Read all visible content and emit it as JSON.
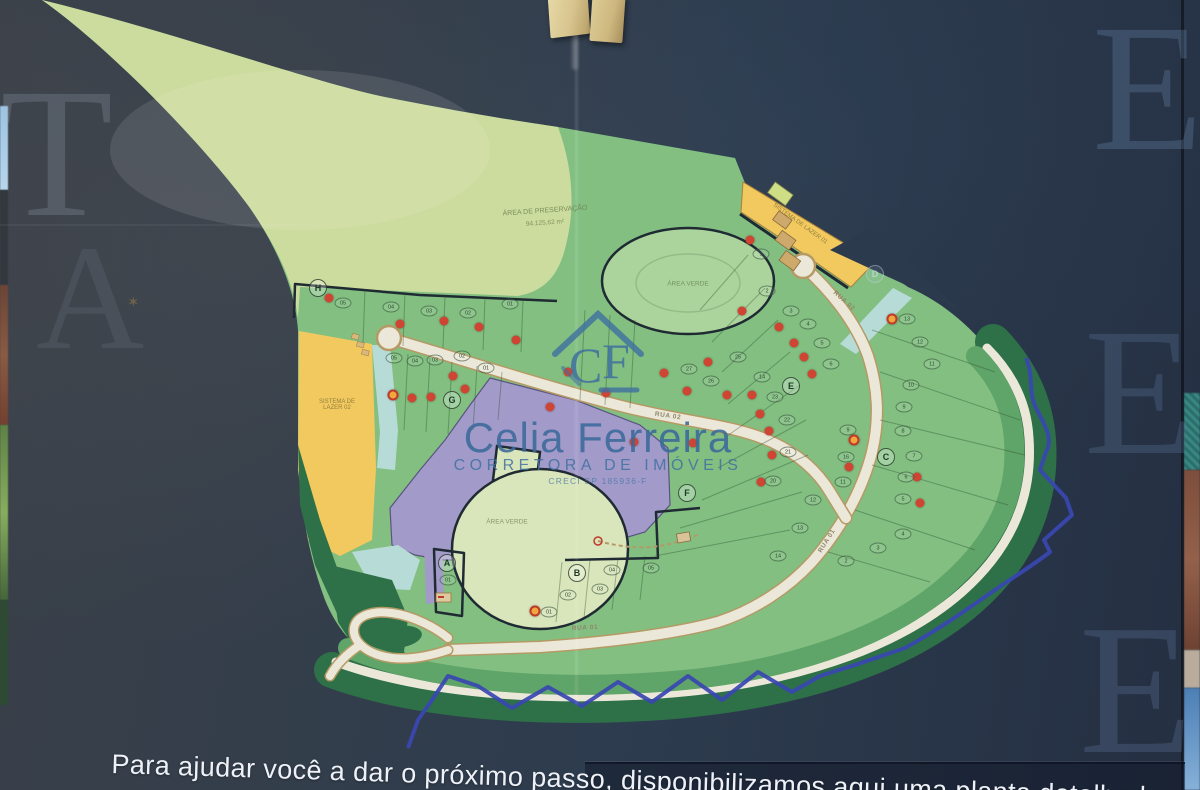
{
  "wall_letters": [
    {
      "ch": "T",
      "x": 0,
      "y": 80,
      "size": 185,
      "color": "rgba(175,188,208,0.20)"
    },
    {
      "ch": "A",
      "x": 36,
      "y": 238,
      "size": 150,
      "color": "rgba(175,188,208,0.10)"
    },
    {
      "ch": "E",
      "x": 1092,
      "y": 16,
      "size": 182,
      "color": "rgba(110,138,176,0.30)"
    },
    {
      "ch": "E",
      "x": 1084,
      "y": 320,
      "size": 182,
      "color": "rgba(98,124,160,0.28)"
    },
    {
      "ch": "E",
      "x": 1079,
      "y": 616,
      "size": 186,
      "color": "rgba(98,124,160,0.30)"
    }
  ],
  "logo": {
    "monogram_c": "C",
    "monogram_f": "F",
    "title": "Celia Ferreira",
    "subtitle": "CORRETORA DE IMÓVEIS",
    "creci": "CRECI SP 185936-F"
  },
  "footer": {
    "text": "Para ajudar você a dar o próximo passo, disponibilizamos aqui uma planta detalhada"
  },
  "map": {
    "area_preservation_line1": "ÁREA DE PRESERVAÇÃO",
    "area_preservation_line2": "94.125,62 m²",
    "green_area_label": "ÁREA VERDE",
    "leisure_left": "SISTEMA DE LAZER 02",
    "leisure_top": "SISTEMA DE LAZER 01",
    "sections": [
      {
        "id": "A",
        "x": 447,
        "y": 563
      },
      {
        "id": "B",
        "x": 577,
        "y": 573
      },
      {
        "id": "C",
        "x": 886,
        "y": 457
      },
      {
        "id": "D",
        "x": 875,
        "y": 274
      },
      {
        "id": "E",
        "x": 791,
        "y": 386
      },
      {
        "id": "F",
        "x": 687,
        "y": 493
      },
      {
        "id": "G",
        "x": 452,
        "y": 400
      },
      {
        "id": "H",
        "x": 318,
        "y": 288
      }
    ],
    "road_labels": [
      {
        "label": "RUA 01",
        "x": 585,
        "y": 628,
        "rot": -3
      },
      {
        "label": "RUA 01",
        "x": 827,
        "y": 541,
        "rot": -58
      },
      {
        "label": "RUA 02",
        "x": 668,
        "y": 416,
        "rot": 8
      },
      {
        "label": "RUA 02",
        "x": 844,
        "y": 301,
        "rot": 42
      }
    ],
    "lots": [
      {
        "n": "05",
        "x": 343,
        "y": 303
      },
      {
        "n": "04",
        "x": 391,
        "y": 307
      },
      {
        "n": "03",
        "x": 429,
        "y": 311
      },
      {
        "n": "02",
        "x": 468,
        "y": 313
      },
      {
        "n": "01",
        "x": 510,
        "y": 304
      },
      {
        "n": "05",
        "x": 394,
        "y": 358
      },
      {
        "n": "04",
        "x": 415,
        "y": 361
      },
      {
        "n": "03",
        "x": 435,
        "y": 360
      },
      {
        "n": "02",
        "x": 462,
        "y": 356
      },
      {
        "n": "01",
        "x": 486,
        "y": 368
      },
      {
        "n": "01",
        "x": 448,
        "y": 580
      },
      {
        "n": "01",
        "x": 549,
        "y": 612
      },
      {
        "n": "02",
        "x": 568,
        "y": 595
      },
      {
        "n": "03",
        "x": 600,
        "y": 589
      },
      {
        "n": "04",
        "x": 612,
        "y": 570
      },
      {
        "n": "05",
        "x": 651,
        "y": 568
      },
      {
        "n": "1",
        "x": 761,
        "y": 254
      },
      {
        "n": "2",
        "x": 767,
        "y": 291
      },
      {
        "n": "3",
        "x": 791,
        "y": 311
      },
      {
        "n": "4",
        "x": 808,
        "y": 324
      },
      {
        "n": "5",
        "x": 822,
        "y": 343
      },
      {
        "n": "6",
        "x": 831,
        "y": 364
      },
      {
        "n": "25",
        "x": 738,
        "y": 357
      },
      {
        "n": "14",
        "x": 762,
        "y": 377
      },
      {
        "n": "23",
        "x": 775,
        "y": 397
      },
      {
        "n": "27",
        "x": 689,
        "y": 369
      },
      {
        "n": "26",
        "x": 711,
        "y": 381
      },
      {
        "n": "13",
        "x": 907,
        "y": 319
      },
      {
        "n": "12",
        "x": 920,
        "y": 342
      },
      {
        "n": "11",
        "x": 932,
        "y": 364
      },
      {
        "n": "10",
        "x": 911,
        "y": 385
      },
      {
        "n": "9",
        "x": 904,
        "y": 407
      },
      {
        "n": "22",
        "x": 787,
        "y": 420
      },
      {
        "n": "9",
        "x": 848,
        "y": 430
      },
      {
        "n": "8",
        "x": 903,
        "y": 431
      },
      {
        "n": "21",
        "x": 788,
        "y": 452
      },
      {
        "n": "16",
        "x": 846,
        "y": 457
      },
      {
        "n": "7",
        "x": 914,
        "y": 456
      },
      {
        "n": "20",
        "x": 773,
        "y": 481
      },
      {
        "n": "11",
        "x": 843,
        "y": 482
      },
      {
        "n": "6",
        "x": 906,
        "y": 477
      },
      {
        "n": "12",
        "x": 813,
        "y": 500
      },
      {
        "n": "5",
        "x": 903,
        "y": 499
      },
      {
        "n": "13",
        "x": 800,
        "y": 528
      },
      {
        "n": "4",
        "x": 903,
        "y": 534
      },
      {
        "n": "14",
        "x": 778,
        "y": 556
      },
      {
        "n": "3",
        "x": 878,
        "y": 548
      },
      {
        "n": "2",
        "x": 846,
        "y": 561
      }
    ],
    "sold_dots": [
      [
        329,
        298
      ],
      [
        400,
        324
      ],
      [
        444,
        321
      ],
      [
        479,
        327
      ],
      [
        516,
        340
      ],
      [
        453,
        376
      ],
      [
        465,
        389
      ],
      [
        412,
        398
      ],
      [
        431,
        397
      ],
      [
        550,
        407
      ],
      [
        568,
        372
      ],
      [
        606,
        393
      ],
      [
        634,
        442
      ],
      [
        664,
        373
      ],
      [
        687,
        391
      ],
      [
        693,
        443
      ],
      [
        750,
        240
      ],
      [
        742,
        311
      ],
      [
        779,
        327
      ],
      [
        794,
        343
      ],
      [
        804,
        357
      ],
      [
        812,
        374
      ],
      [
        752,
        395
      ],
      [
        760,
        414
      ],
      [
        769,
        431
      ],
      [
        772,
        455
      ],
      [
        761,
        482
      ],
      [
        849,
        467
      ],
      [
        917,
        477
      ],
      [
        920,
        503
      ],
      [
        727,
        395
      ],
      [
        708,
        362
      ]
    ],
    "reserved_dots": [
      [
        393,
        395
      ],
      [
        892,
        319
      ],
      [
        854,
        440
      ],
      [
        535,
        611
      ]
    ],
    "palette": {
      "sold_dot": "#cf4433",
      "reserved_dot": "#f0a83c",
      "preservation_green": "#ccdc9e",
      "lots_green": "#82bf81",
      "dark_green": "#2e7048",
      "road_cream": "#ece8d9",
      "leisure_yellow": "#f2c95f",
      "green_area_purple": "#a29ac9",
      "water_blue": "#b7dcd8",
      "boundary_blue": "#3a46b2",
      "wall_navy": "#2d3c4f"
    }
  }
}
